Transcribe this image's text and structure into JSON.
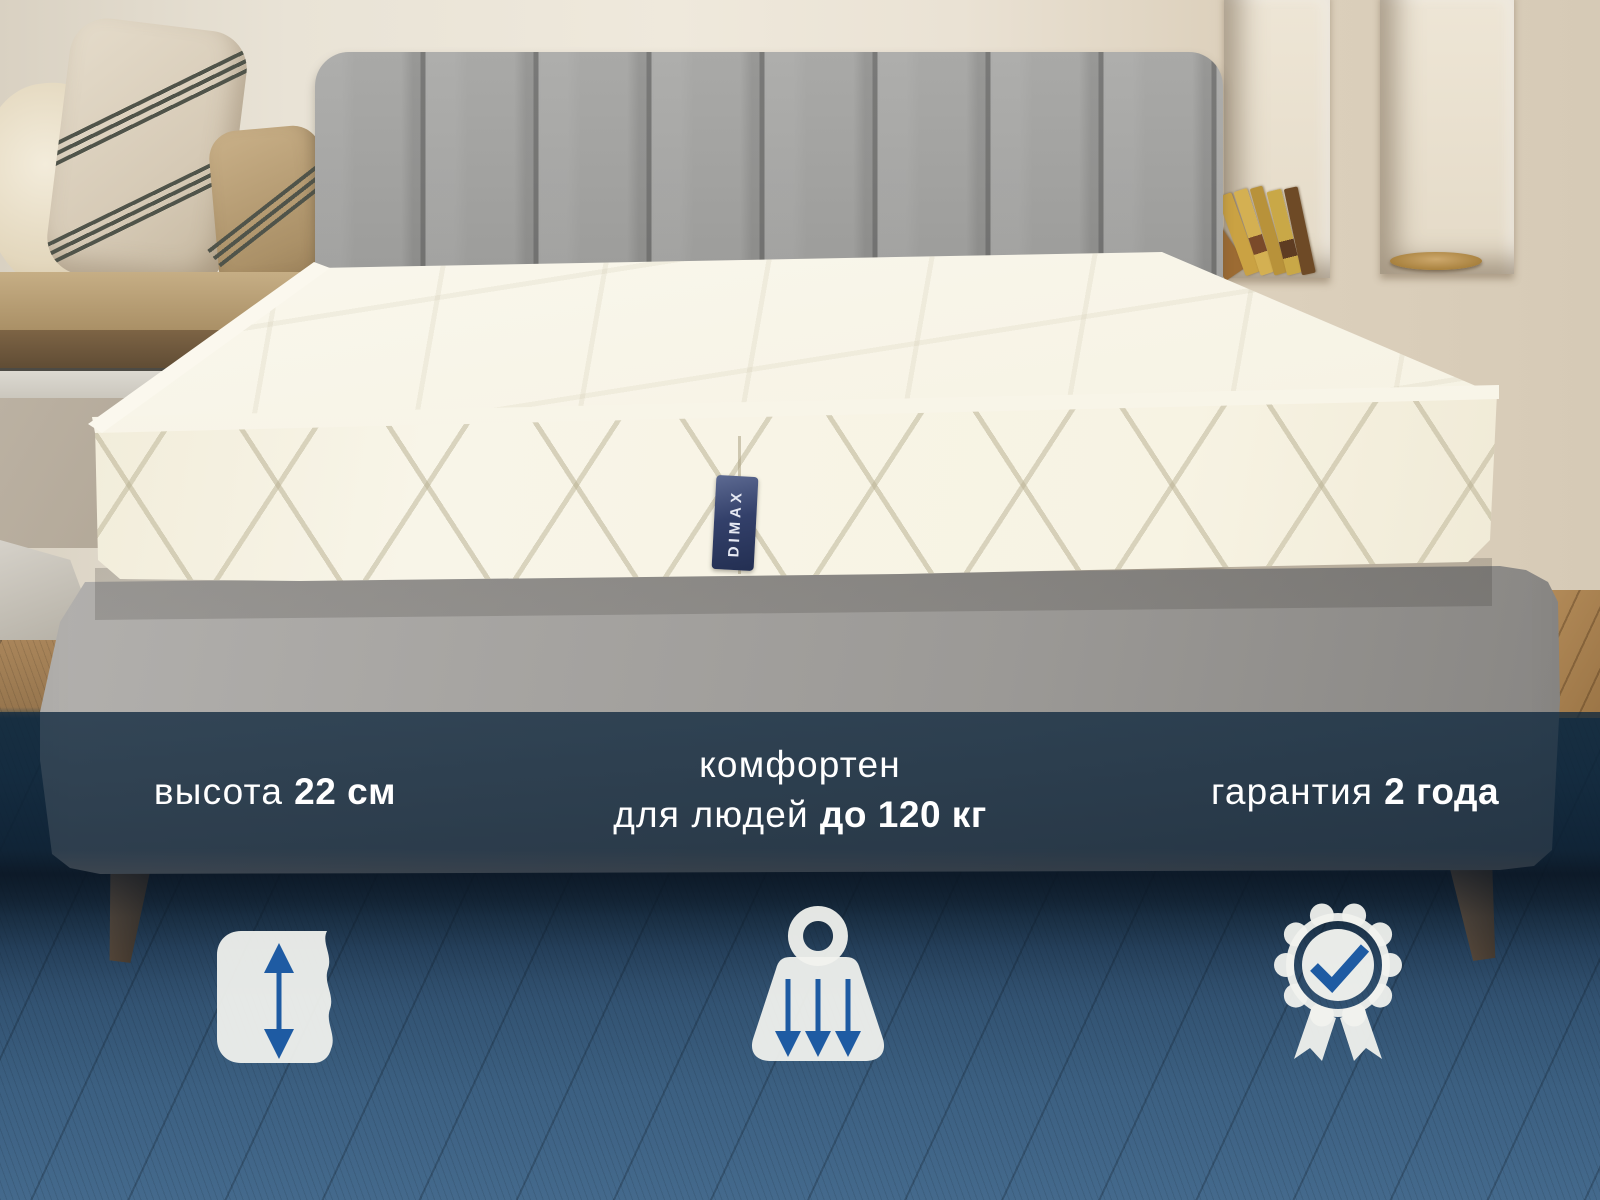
{
  "brand_label": "DIMAX",
  "features": {
    "height": {
      "regular": "высота",
      "bold": "22 см"
    },
    "capacity": {
      "line1": "комфортен",
      "line2_regular": "для людей",
      "line2_bold": "до 120 кг"
    },
    "warranty": {
      "regular": "гарантия",
      "bold": "2 года"
    }
  },
  "colors": {
    "accent_blue": "#1E5BA3",
    "overlay_navy": "#1D3F5B",
    "icon_fill": "#F1F2EE",
    "text": "#FFFFFF",
    "mattress_ivory": "#F6F2E2",
    "headboard_gray": "#9C9C9A",
    "floor_blue": "#4A7195"
  }
}
